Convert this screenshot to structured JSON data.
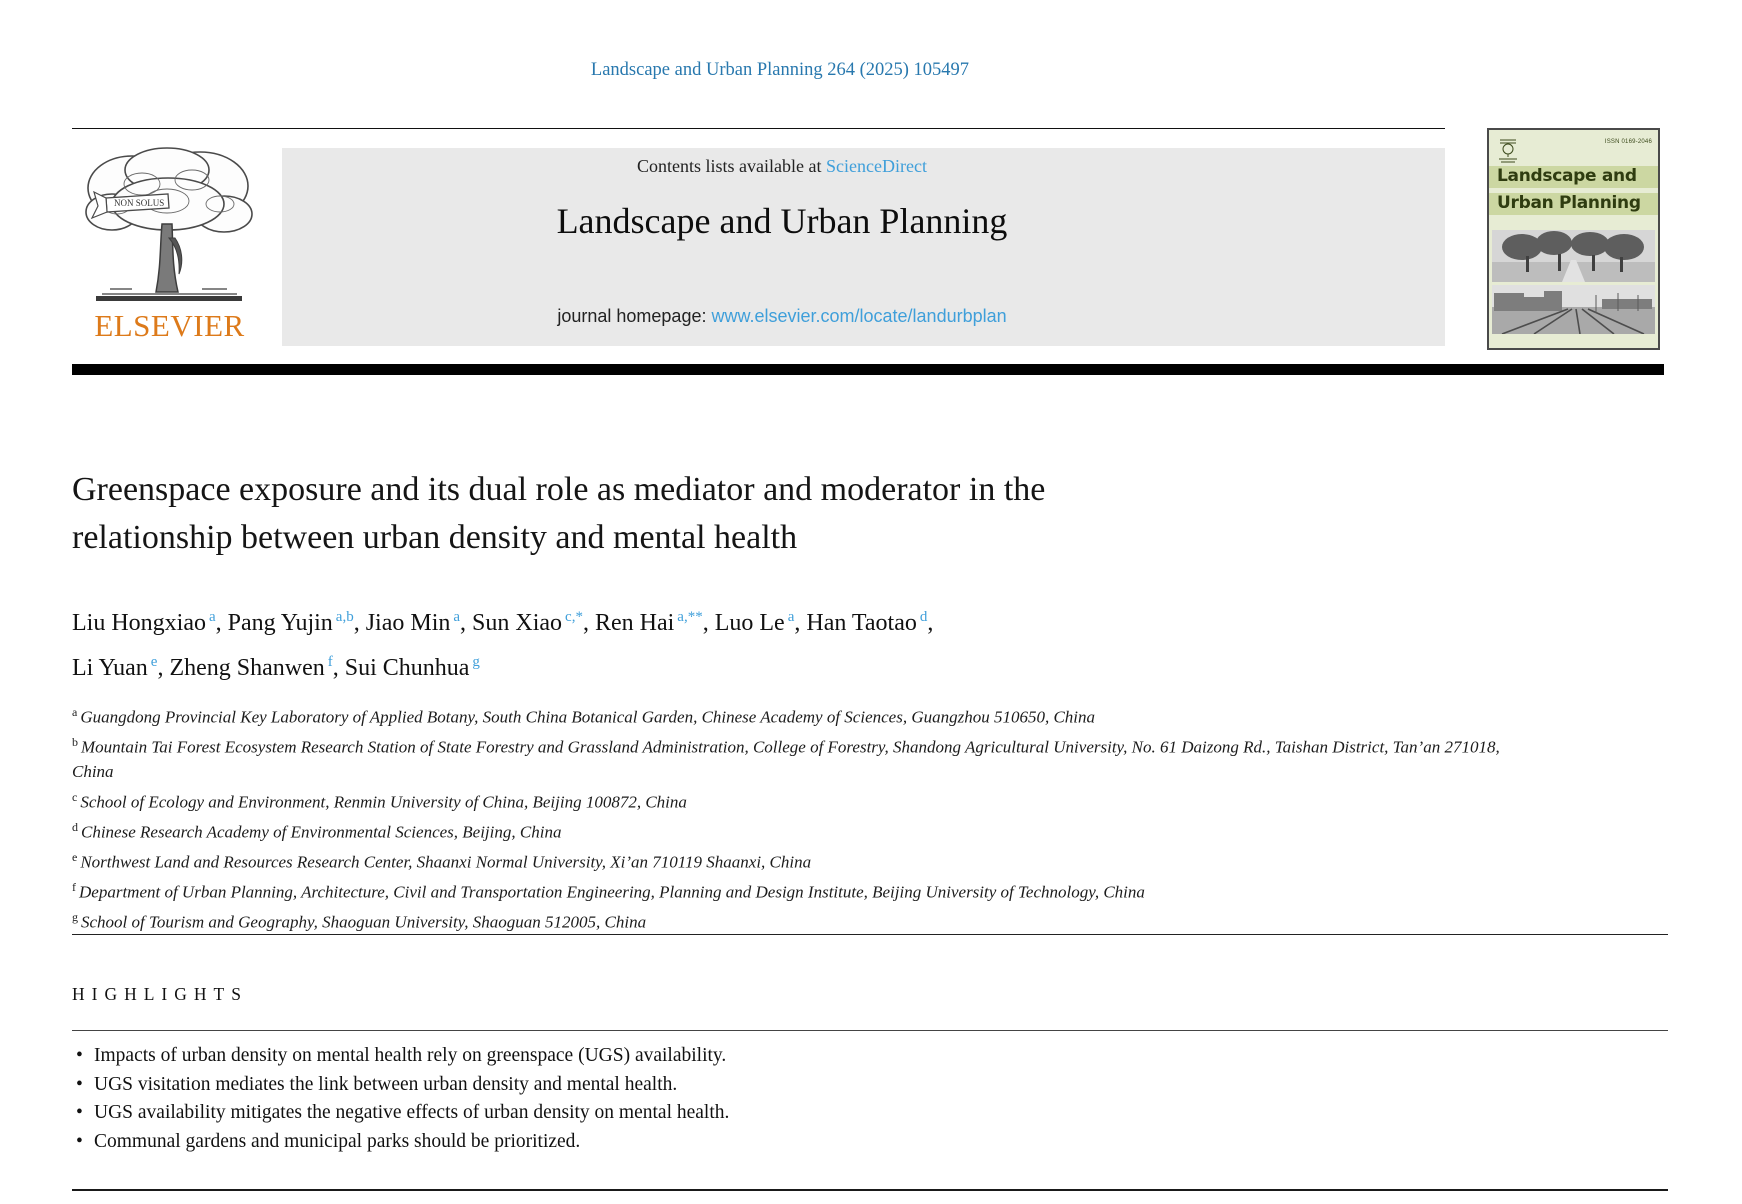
{
  "colors": {
    "citation_blue": "#2878ae",
    "link_blue": "#3f9fda",
    "elsevier_orange": "#dd7a1a",
    "banner_gray": "#e9e9e9",
    "cover_background_green": "#e7ecd4",
    "cover_band_green": "#ccd7a2",
    "cover_text_green": "#2f3c10"
  },
  "citation": "Landscape and Urban Planning 264 (2025) 105497",
  "banner": {
    "contents_prefix": "Contents lists available at ",
    "sciencedirect_link": "ScienceDirect",
    "journal_title": "Landscape and Urban Planning",
    "homepage_label": "journal homepage: ",
    "homepage_url": "www.elsevier.com/locate/landurbplan"
  },
  "elsevier": {
    "wordmark": "ELSEVIER",
    "motto": "NON SOLUS"
  },
  "cover": {
    "issn": "ISSN 0169-2046",
    "title_line1": "Landscape and",
    "title_line2": "Urban Planning"
  },
  "article": {
    "title_line1": "Greenspace exposure and its dual role as mediator and moderator in the",
    "title_line2": "relationship between urban density and mental health",
    "authors": [
      {
        "name": "Liu Hongxiao",
        "sup": "a",
        "sep": ", "
      },
      {
        "name": "Pang Yujin",
        "sup": "a,b",
        "sep": ", "
      },
      {
        "name": "Jiao Min",
        "sup": "a",
        "sep": ", "
      },
      {
        "name": "Sun Xiao",
        "sup": "c,*",
        "sep": ", "
      },
      {
        "name": "Ren Hai",
        "sup": "a,**",
        "sep": ", "
      },
      {
        "name": "Luo Le",
        "sup": "a",
        "sep": ", "
      },
      {
        "name": "Han Taotao",
        "sup": "d",
        "sep": ","
      },
      {
        "name": "Li Yuan",
        "sup": "e",
        "sep": ", "
      },
      {
        "name": "Zheng Shanwen",
        "sup": "f",
        "sep": ", "
      },
      {
        "name": "Sui Chunhua",
        "sup": "g",
        "sep": ""
      }
    ],
    "affiliations": [
      {
        "sup": "a",
        "text": "Guangdong Provincial Key Laboratory of Applied Botany, South China Botanical Garden, Chinese Academy of Sciences, Guangzhou 510650, China"
      },
      {
        "sup": "b",
        "text": "Mountain Tai Forest Ecosystem Research Station of State Forestry and Grassland Administration, College of Forestry, Shandong Agricultural University, No. 61 Daizong Rd., Taishan District, Tan’an 271018, China"
      },
      {
        "sup": "c",
        "text": "School of Ecology and Environment, Renmin University of China, Beijing 100872, China"
      },
      {
        "sup": "d",
        "text": "Chinese Research Academy of Environmental Sciences, Beijing, China"
      },
      {
        "sup": "e",
        "text": "Northwest Land and Resources Research Center, Shaanxi Normal University, Xi’an 710119 Shaanxi, China"
      },
      {
        "sup": "f",
        "text": "Department of Urban Planning, Architecture, Civil and Transportation Engineering, Planning and Design Institute, Beijing University of Technology, China"
      },
      {
        "sup": "g",
        "text": "School of Tourism and Geography, Shaoguan University, Shaoguan 512005, China"
      }
    ]
  },
  "highlights": {
    "heading": "HIGHLIGHTS",
    "marker": "•",
    "items": [
      "Impacts of urban density on mental health rely on greenspace (UGS) availability.",
      "UGS visitation mediates the link between urban density and mental health.",
      "UGS availability mitigates the negative effects of urban density on mental health.",
      "Communal gardens and municipal parks should be prioritized."
    ]
  }
}
